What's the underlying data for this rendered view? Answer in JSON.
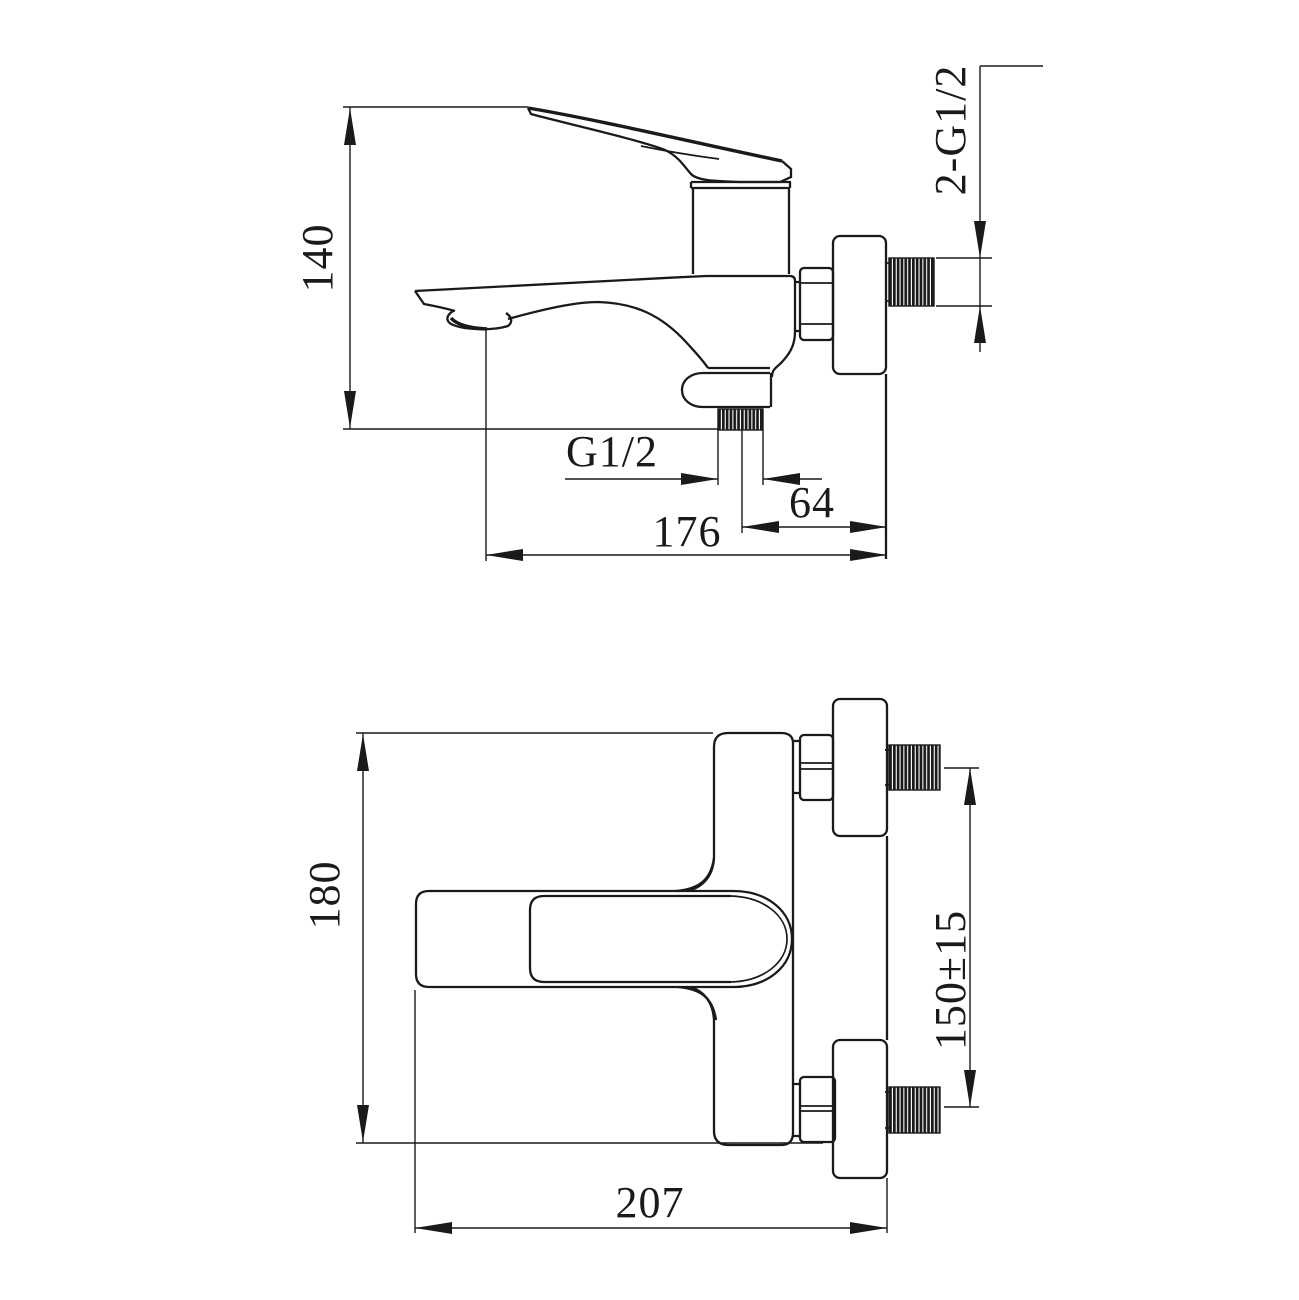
{
  "page": {
    "background": "#ffffff",
    "line_color": "#1a1a1a"
  },
  "side_view": {
    "dims": {
      "height": "140",
      "wall_thread": "2-G1/2",
      "outlet_thread": "G1/2",
      "outlet_to_wall": "64",
      "reach": "176"
    }
  },
  "front_view": {
    "dims": {
      "height": "180",
      "inlet_spacing": "150±15",
      "width": "207"
    }
  }
}
